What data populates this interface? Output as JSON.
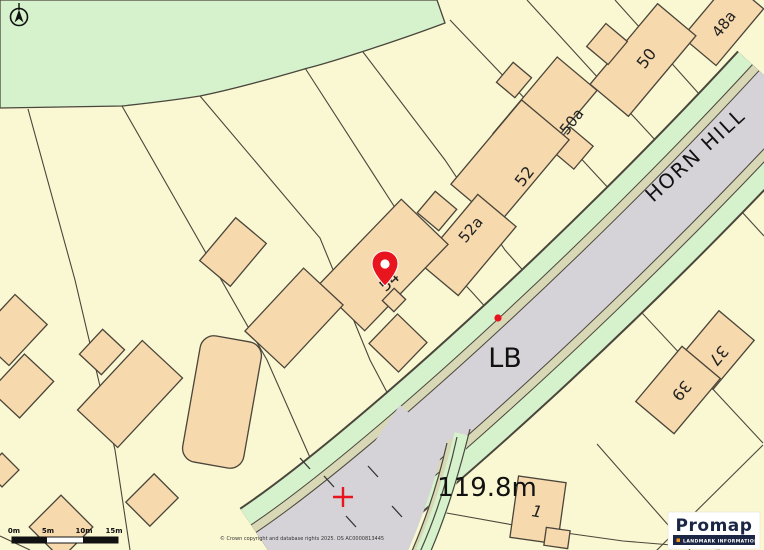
{
  "road": {
    "name": "HORN HILL"
  },
  "map_labels": {
    "lb": "LB",
    "spot_height": "119.8m"
  },
  "houses": {
    "h48a": "48a",
    "h50": "50",
    "h50a": "50a",
    "h52": "52",
    "h52a": "52a",
    "h54": "54",
    "h37": "37",
    "h39": "39",
    "h1": "1"
  },
  "scale_bar": {
    "ticks": [
      "0m",
      "5m",
      "10m",
      "15m"
    ]
  },
  "footer": {
    "copyright": "© Crown copyright and database rights 2025. OS AC0000813445"
  },
  "logo": {
    "brand": "Promap",
    "tagline": "LANDMARK INFORMATION"
  },
  "colors": {
    "land": "#FAF8D2",
    "greenspace": "#D6F2CC",
    "road_edge_khaki": "#D9D8B6",
    "road_surface": "#D5D3D7",
    "building": "#F6D9AC",
    "marker_red": "#E8141E",
    "logo_navy": "#1B2644",
    "logo_orange": "#F7941D"
  }
}
